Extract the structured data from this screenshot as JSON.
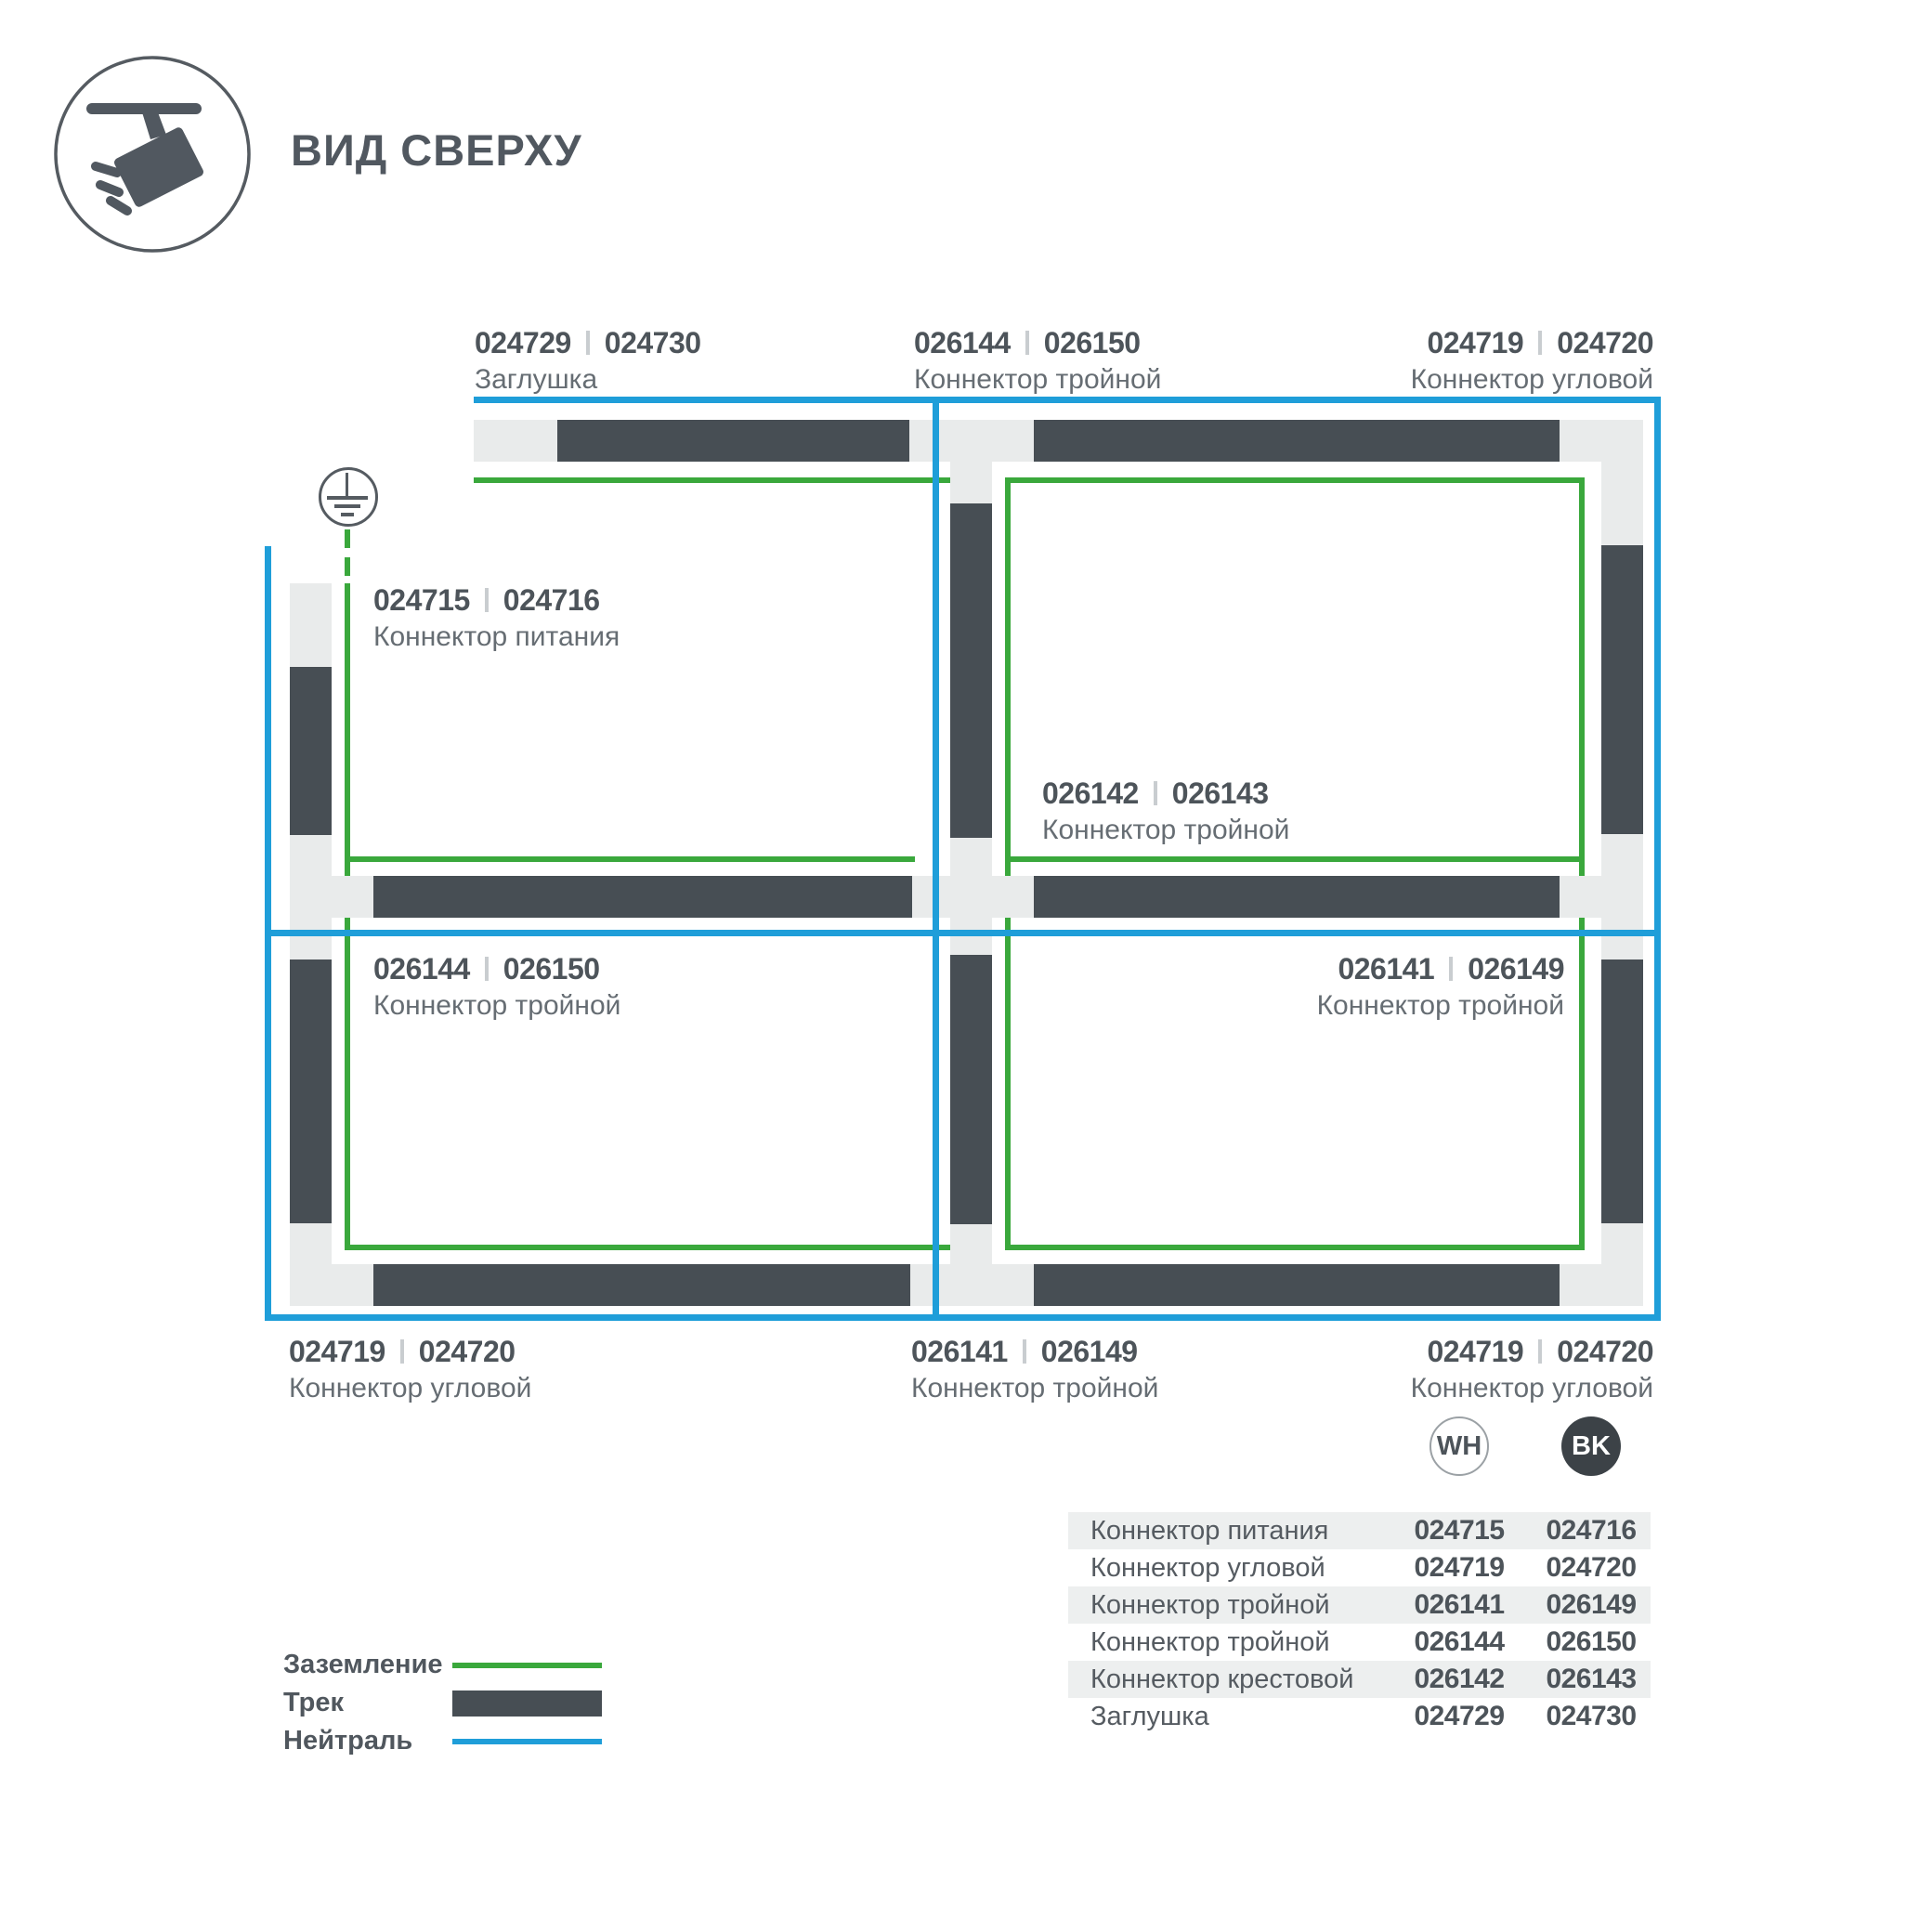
{
  "header": {
    "title": "ВИД СВЕРХУ"
  },
  "colors": {
    "track": "#474e54",
    "connector": "#e9ebeb",
    "ground_green": "#3aa83c",
    "neutral_blue": "#1f9ed9",
    "text_dark": "#4d545a",
    "text_gray": "#666d73",
    "bk_badge": "#3c4247",
    "table_row_alt": "#edefef"
  },
  "diagram": {
    "labels": [
      {
        "id": "cap-top",
        "num1": "024729",
        "num2": "024730",
        "name": "Заглушка"
      },
      {
        "id": "tee-top",
        "num1": "026144",
        "num2": "026150",
        "name": "Коннектор тройной"
      },
      {
        "id": "corner-top-right",
        "num1": "024719",
        "num2": "024720",
        "name": "Коннектор угловой"
      },
      {
        "id": "power-connector",
        "num1": "024715",
        "num2": "024716",
        "name": "Коннектор питания"
      },
      {
        "id": "cross-center",
        "num1": "026142",
        "num2": "026143",
        "name": "Коннектор тройной"
      },
      {
        "id": "tee-left-mid",
        "num1": "026144",
        "num2": "026150",
        "name": "Коннектор тройной"
      },
      {
        "id": "tee-right-mid",
        "num1": "026141",
        "num2": "026149",
        "name": "Коннектор тройной"
      },
      {
        "id": "corner-bottom-left",
        "num1": "024719",
        "num2": "024720",
        "name": "Коннектор угловой"
      },
      {
        "id": "tee-bottom",
        "num1": "026141",
        "num2": "026149",
        "name": "Коннектор тройной"
      },
      {
        "id": "corner-bottom-right",
        "num1": "024719",
        "num2": "024720",
        "name": "Коннектор угловой"
      }
    ]
  },
  "legend": {
    "items": [
      {
        "label": "Заземление",
        "swatch": "ground-line"
      },
      {
        "label": "Трек",
        "swatch": "track-bar"
      },
      {
        "label": "Нейтраль",
        "swatch": "neutral-line"
      }
    ]
  },
  "table": {
    "columns": [
      {
        "code": "WH"
      },
      {
        "code": "BK"
      }
    ],
    "rows": [
      {
        "name": "Коннектор питания",
        "wh": "024715",
        "bk": "024716"
      },
      {
        "name": "Коннектор угловой",
        "wh": "024719",
        "bk": "024720"
      },
      {
        "name": "Коннектор тройной",
        "wh": "026141",
        "bk": "026149"
      },
      {
        "name": "Коннектор тройной",
        "wh": "026144",
        "bk": "026150"
      },
      {
        "name": "Коннектор крестовой",
        "wh": "026142",
        "bk": "026143"
      },
      {
        "name": "Заглушка",
        "wh": "024729",
        "bk": "024730"
      }
    ]
  }
}
